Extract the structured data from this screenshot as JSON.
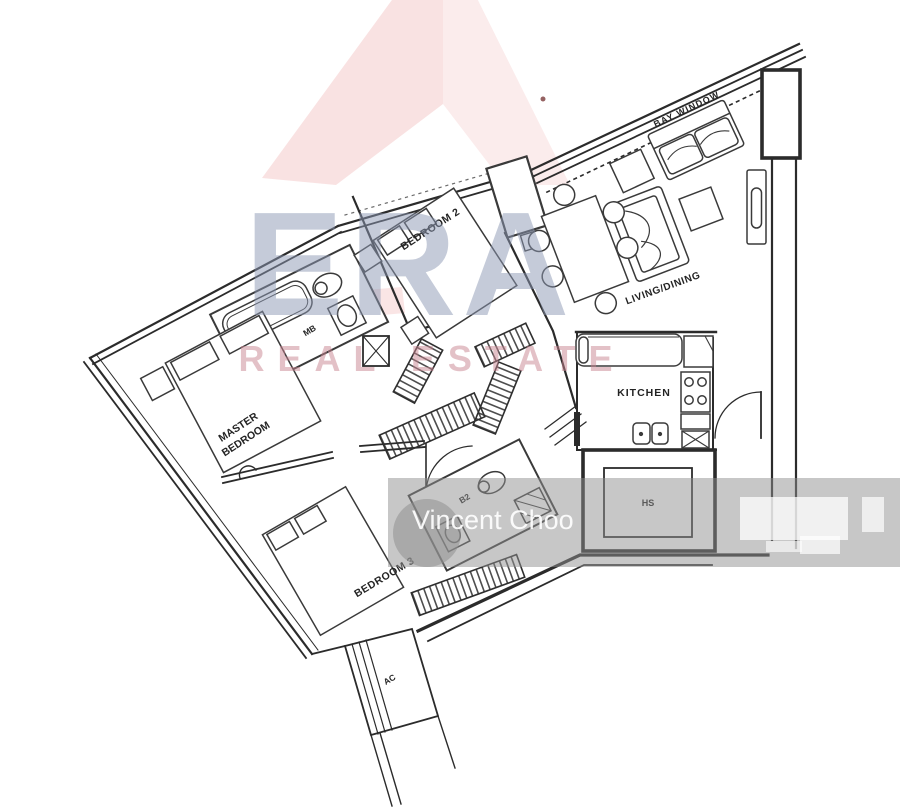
{
  "watermark": {
    "brand": "ERA",
    "tagline": "REAL ESTATE",
    "agent": "Vincent Choo",
    "brand_color": "#8d99b4",
    "tagline_color": "#c98490",
    "arrow_pink": "#e88a8a",
    "band_gray": "#8f8f8f"
  },
  "floorplan": {
    "labels": {
      "bay_window": "BAY WINDOW",
      "bedroom2": "BEDROOM 2",
      "living_dining": "LIVING/DINING",
      "kitchen": "KITCHEN",
      "master_line1": "MASTER",
      "master_line2": "BEDROOM",
      "bedroom3": "BEDROOM 3",
      "master_bath": "MB",
      "bath2": "B2",
      "household_shelter": "HS",
      "ac_ledge": "AC"
    }
  }
}
